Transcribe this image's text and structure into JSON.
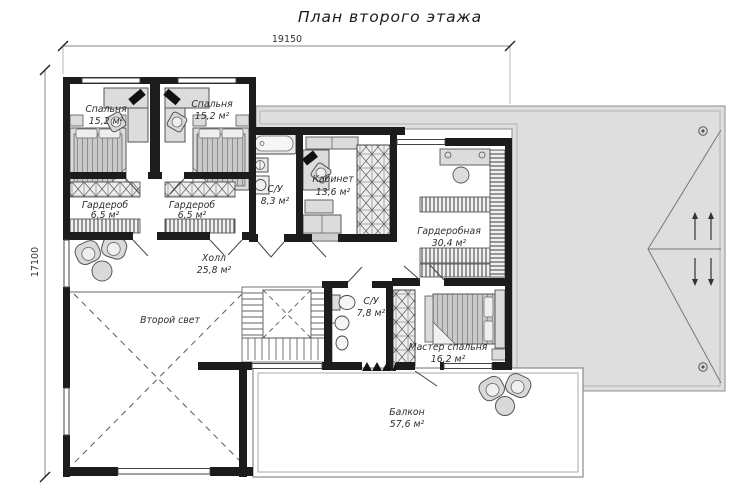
{
  "title": "План второго этажа",
  "dimensions": {
    "width_top": "19150",
    "height_left": "17100"
  },
  "rooms": [
    {
      "id": "bedroom-left",
      "name": "Спальня",
      "area": "15,2 м²"
    },
    {
      "id": "bedroom-right",
      "name": "Спальня",
      "area": "15,2 м²"
    },
    {
      "id": "wardrobe-left",
      "name": "Гардероб",
      "area": "6,5 м²"
    },
    {
      "id": "wardrobe-right",
      "name": "Гардероб",
      "area": "6,5 м²"
    },
    {
      "id": "bath-upper",
      "name": "С/У",
      "area": "8,3 м²"
    },
    {
      "id": "office",
      "name": "Кабинет",
      "area": "13,6 м²"
    },
    {
      "id": "dressing-room",
      "name": "Гардеробная",
      "area": "30,4 м²"
    },
    {
      "id": "hall",
      "name": "Холл",
      "area": "25,8 м²"
    },
    {
      "id": "void",
      "name": "Второй свет",
      "area": ""
    },
    {
      "id": "bath-lower",
      "name": "С/У",
      "area": "7,8 м²"
    },
    {
      "id": "master-bedroom",
      "name": "Мастер спальня",
      "area": "16,2 м²"
    },
    {
      "id": "balcony",
      "name": "Балкон",
      "area": "57,6 м²"
    }
  ],
  "colors": {
    "wall": "#1c1c1c",
    "roof": "#dedede",
    "furniture": "#dcdcdc",
    "line": "#555555"
  }
}
